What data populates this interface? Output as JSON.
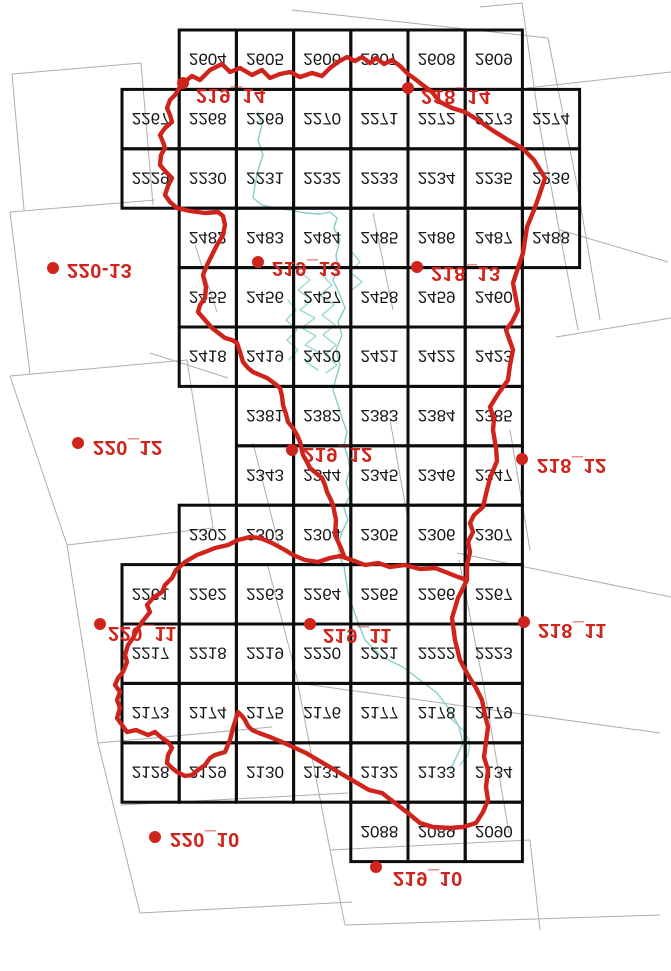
{
  "title": "Map sheet index (vertically flipped scan)",
  "canvas": {
    "width": 671,
    "height": 971,
    "background": "#ffffff"
  },
  "colors": {
    "grid_line": "#0d0d0d",
    "cell_text": "#161616",
    "sheet_outline": "#aeaeae",
    "red": "#cf241c",
    "river": "#85cec8",
    "river_light": "#9ad8d2"
  },
  "grid": {
    "col_origin": 122,
    "col_width": 57.2,
    "row_origin": 30,
    "row_height": 59.4,
    "stroke_width": 3,
    "cell_font_size": 17,
    "rows": [
      {
        "start_col": 1,
        "cells": [
          "2604",
          "2605",
          "2606",
          "2607",
          "2608",
          "2609"
        ]
      },
      {
        "start_col": 0,
        "cells": [
          "2267",
          "2268",
          "2269",
          "2270",
          "2271",
          "2272",
          "2273",
          "2274"
        ]
      },
      {
        "start_col": 0,
        "cells": [
          "2229",
          "2230",
          "2231",
          "2232",
          "2233",
          "2234",
          "2235",
          "2236"
        ]
      },
      {
        "start_col": 1,
        "cells": [
          "2482",
          "2483",
          "2484",
          "2485",
          "2486",
          "2487",
          "2488"
        ]
      },
      {
        "start_col": 1,
        "cells": [
          "2455",
          "2456",
          "2457",
          "2458",
          "2459",
          "2460"
        ]
      },
      {
        "start_col": 1,
        "cells": [
          "2418",
          "2419",
          "2420",
          "2421",
          "2422",
          "2423"
        ]
      },
      {
        "start_col": 2,
        "cells": [
          "2381",
          "2382",
          "2383",
          "2384",
          "2385"
        ]
      },
      {
        "start_col": 2,
        "cells": [
          "2343",
          "2344",
          "2345",
          "2346",
          "2347"
        ]
      },
      {
        "start_col": 1,
        "cells": [
          "2302",
          "2303",
          "2304",
          "2305",
          "2306",
          "2307"
        ]
      },
      {
        "start_col": 0,
        "cells": [
          "2261",
          "2262",
          "2263",
          "2264",
          "2265",
          "2266",
          "2267"
        ]
      },
      {
        "start_col": 0,
        "cells": [
          "2217",
          "2218",
          "2219",
          "2220",
          "2221",
          "2222",
          "2223"
        ]
      },
      {
        "start_col": 0,
        "cells": [
          "2173",
          "2174",
          "2175",
          "2176",
          "2177",
          "2178",
          "2179"
        ]
      },
      {
        "start_col": 0,
        "cells": [
          "2128",
          "2129",
          "2130",
          "2131",
          "2132",
          "2133",
          "2134"
        ]
      },
      {
        "start_col": 4,
        "cells": [
          "2088",
          "2089",
          "2090"
        ]
      }
    ]
  },
  "sheets": {
    "dot_radius": 6,
    "label_font_size": 20,
    "labels": [
      {
        "text": "219_14",
        "dot": [
          183,
          83
        ],
        "label_pos": [
          196,
          96
        ]
      },
      {
        "text": "218_14",
        "dot": [
          408,
          88
        ],
        "label_pos": [
          421,
          97
        ]
      },
      {
        "text": "220-13",
        "dot": [
          53,
          268
        ],
        "label_pos": [
          67,
          271
        ]
      },
      {
        "text": "219_13",
        "dot": [
          258,
          262
        ],
        "label_pos": [
          272,
          269
        ]
      },
      {
        "text": "218_13",
        "dot": [
          417,
          267
        ],
        "label_pos": [
          431,
          274
        ]
      },
      {
        "text": "220_12",
        "dot": [
          78,
          443
        ],
        "label_pos": [
          93,
          448
        ]
      },
      {
        "text": "219_12",
        "dot": [
          292,
          450
        ],
        "label_pos": [
          303,
          455
        ]
      },
      {
        "text": "218_12",
        "dot": [
          522,
          459
        ],
        "label_pos": [
          537,
          466
        ]
      },
      {
        "text": "220_11",
        "dot": [
          100,
          624
        ],
        "label_pos": [
          108,
          634
        ]
      },
      {
        "text": "219_11",
        "dot": [
          310,
          624
        ],
        "label_pos": [
          323,
          636
        ]
      },
      {
        "text": "218_11",
        "dot": [
          524,
          622
        ],
        "label_pos": [
          538,
          631
        ]
      },
      {
        "text": "220_10",
        "dot": [
          155,
          837
        ],
        "label_pos": [
          170,
          840
        ]
      },
      {
        "text": "219_10",
        "dot": [
          376,
          867
        ],
        "label_pos": [
          393,
          879
        ]
      }
    ]
  },
  "boundary": {
    "stroke_width": 4.4,
    "paths": [
      [
        183,
        83,
        192,
        76,
        200,
        80,
        210,
        70,
        222,
        64,
        230,
        72,
        240,
        68,
        252,
        75,
        262,
        70,
        270,
        78,
        280,
        74,
        290,
        72,
        300,
        77,
        312,
        73,
        322,
        76,
        330,
        68,
        338,
        62,
        347,
        57,
        355,
        61,
        362,
        57,
        370,
        63,
        376,
        58,
        384,
        64,
        392,
        60,
        400,
        66,
        408,
        74,
        415,
        79,
        424,
        86,
        432,
        92,
        440,
        102,
        452,
        108,
        465,
        112,
        478,
        120,
        492,
        130,
        508,
        140,
        522,
        148,
        534,
        160,
        545,
        178,
        539,
        196,
        534,
        210,
        527,
        227,
        523,
        253,
        513,
        283,
        518,
        310,
        512,
        322,
        506,
        330,
        513,
        350,
        510,
        365,
        508,
        380,
        498,
        394,
        490,
        407,
        494,
        419,
        493,
        430,
        496,
        448,
        497,
        461,
        490,
        478,
        486,
        494,
        483,
        507,
        474,
        515,
        470,
        523,
        473,
        532,
        468,
        542,
        470,
        552,
        467,
        565,
        467,
        580,
        458,
        598,
        452,
        618,
        455,
        640,
        460,
        660,
        468,
        675,
        476,
        688,
        482,
        700,
        485,
        715,
        488,
        727,
        486,
        742,
        484,
        757,
        488,
        770,
        486,
        787,
        488,
        800,
        483,
        812,
        476,
        823,
        463,
        827,
        450,
        828,
        433,
        827,
        420,
        823,
        408,
        813,
        395,
        803,
        382,
        793,
        369,
        790,
        357,
        783,
        340,
        773,
        323,
        763,
        306,
        753,
        293,
        747,
        282,
        742,
        270,
        737,
        259,
        733,
        252,
        730,
        248,
        726,
        245,
        720,
        242,
        716,
        238,
        712,
        233,
        728,
        230,
        740,
        225,
        752,
        215,
        755,
        210,
        758,
        205,
        765,
        198,
        770,
        192,
        775,
        185,
        776,
        177,
        772,
        172,
        768,
        167,
        763,
        168,
        755,
        172,
        748,
        168,
        742,
        162,
        738,
        155,
        732,
        148,
        735,
        136,
        730,
        127,
        732,
        122,
        725,
        117,
        718,
        120,
        708,
        117,
        700,
        120,
        692,
        115,
        685,
        118,
        678,
        123,
        672,
        127,
        662,
        125,
        655,
        128,
        645,
        133,
        638,
        137,
        630,
        142,
        622,
        150,
        612,
        147,
        605,
        153,
        598,
        162,
        592,
        165,
        585,
        172,
        578,
        176,
        570,
        185,
        562,
        190,
        559,
        197,
        555,
        205,
        552,
        215,
        548,
        228,
        545,
        238,
        540,
        250,
        537,
        260,
        538,
        272,
        543,
        285,
        550,
        293,
        555,
        305,
        560,
        318,
        562,
        330,
        558,
        340,
        556,
        352,
        560,
        365,
        565,
        378,
        563,
        390,
        567,
        405,
        565,
        420,
        569,
        435,
        568,
        448,
        573,
        458,
        577,
        467,
        580
      ],
      [
        183,
        83,
        178,
        90,
        175,
        95,
        170,
        100,
        167,
        108,
        170,
        115,
        172,
        122,
        165,
        128,
        160,
        135,
        163,
        142,
        165,
        148,
        161,
        155,
        160,
        165,
        166,
        172,
        172,
        178,
        168,
        186,
        165,
        195,
        170,
        202,
        177,
        208,
        190,
        211,
        205,
        213,
        218,
        212,
        223,
        216,
        225,
        225,
        223,
        235,
        217,
        245,
        212,
        255,
        207,
        265,
        203,
        275,
        206,
        287,
        205,
        298,
        200,
        305,
        198,
        312,
        205,
        320,
        212,
        328,
        225,
        338,
        232,
        340,
        237,
        343,
        240,
        352,
        243,
        362,
        248,
        368,
        253,
        372,
        260,
        375,
        267,
        378,
        274,
        383,
        280,
        388,
        282,
        396,
        283,
        405,
        286,
        414,
        288,
        422,
        293,
        428,
        297,
        435,
        300,
        442,
        303,
        455,
        307,
        462,
        310,
        468,
        316,
        473,
        322,
        478,
        325,
        485,
        327,
        492,
        330,
        498,
        333,
        505,
        336,
        520,
        335,
        535,
        341,
        548,
        344,
        556
      ]
    ]
  },
  "rivers": {
    "stroke_width": 1.4,
    "paths": [
      [
        258,
        112,
        262,
        125,
        258,
        140,
        263,
        155,
        258,
        170,
        255,
        185,
        253,
        198,
        262,
        205,
        275,
        208,
        290,
        210,
        305,
        213,
        320,
        214,
        330,
        212,
        337,
        218,
        334,
        228,
        340,
        240,
        336,
        255,
        338,
        268,
        333,
        280,
        340,
        295,
        345,
        308,
        338,
        322,
        342,
        335,
        336,
        350,
        340,
        365,
        336,
        378,
        333,
        390,
        338,
        405,
        342,
        418,
        347,
        432,
        344,
        445,
        348,
        458,
        350,
        470,
        346,
        482,
        350,
        495,
        344,
        508,
        348,
        520,
        342,
        532,
        338,
        545,
        340,
        558,
        344,
        566,
        348,
        593,
        357,
        620,
        365,
        640,
        382,
        657,
        403,
        667,
        420,
        680,
        437,
        693,
        450,
        710,
        459,
        727,
        463,
        743,
        456,
        758,
        450,
        770
      ],
      [
        300,
        272,
        310,
        280,
        298,
        290,
        312,
        300,
        300,
        310,
        315,
        318,
        302,
        328,
        316,
        336,
        305,
        345,
        318,
        352,
        306,
        362,
        318,
        370
      ],
      [
        322,
        275,
        332,
        285,
        320,
        295,
        334,
        305,
        322,
        315,
        335,
        325,
        323,
        335,
        336,
        345,
        325,
        355,
        337,
        365,
        326,
        373
      ],
      [
        288,
        300,
        296,
        310,
        286,
        320,
        297,
        330,
        287,
        340,
        298,
        350,
        289,
        360
      ],
      [
        352,
        252,
        360,
        262,
        350,
        272,
        362,
        282,
        352,
        290
      ],
      [
        450,
        718,
        463,
        730,
        470,
        742,
        468,
        755,
        460,
        765
      ]
    ]
  },
  "lattice": {
    "stroke_width": 1,
    "segments": [
      [
        12,
        74,
        141,
        63
      ],
      [
        141,
        63,
        153,
        205
      ],
      [
        12,
        74,
        24,
        210
      ],
      [
        10,
        212,
        155,
        200
      ],
      [
        10,
        212,
        30,
        374
      ],
      [
        10,
        376,
        187,
        360
      ],
      [
        10,
        376,
        67,
        545
      ],
      [
        187,
        360,
        213,
        528
      ],
      [
        67,
        545,
        213,
        528
      ],
      [
        67,
        545,
        98,
        743
      ],
      [
        98,
        743,
        272,
        727
      ],
      [
        121,
        805,
        348,
        793
      ],
      [
        98,
        743,
        140,
        913
      ],
      [
        140,
        913,
        352,
        902
      ],
      [
        298,
        685,
        330,
        850
      ],
      [
        330,
        850,
        345,
        925
      ],
      [
        330,
        850,
        530,
        840
      ],
      [
        530,
        840,
        540,
        930
      ],
      [
        345,
        925,
        660,
        915
      ],
      [
        480,
        7,
        522,
        3
      ],
      [
        522,
        3,
        540,
        128
      ],
      [
        540,
        128,
        578,
        330
      ],
      [
        292,
        10,
        548,
        38
      ],
      [
        548,
        38,
        578,
        190
      ],
      [
        578,
        190,
        600,
        320
      ],
      [
        527,
        88,
        671,
        72
      ],
      [
        560,
        230,
        668,
        262
      ],
      [
        556,
        337,
        671,
        318
      ],
      [
        195,
        245,
        217,
        312
      ],
      [
        373,
        213,
        393,
        310
      ],
      [
        253,
        443,
        280,
        550
      ],
      [
        390,
        420,
        408,
        520
      ],
      [
        267,
        563,
        298,
        682
      ],
      [
        459,
        560,
        484,
        687
      ],
      [
        484,
        687,
        509,
        833
      ],
      [
        457,
        553,
        671,
        597
      ],
      [
        510,
        430,
        530,
        550
      ],
      [
        297,
        683,
        660,
        733
      ],
      [
        150,
        353,
        228,
        378
      ]
    ]
  }
}
